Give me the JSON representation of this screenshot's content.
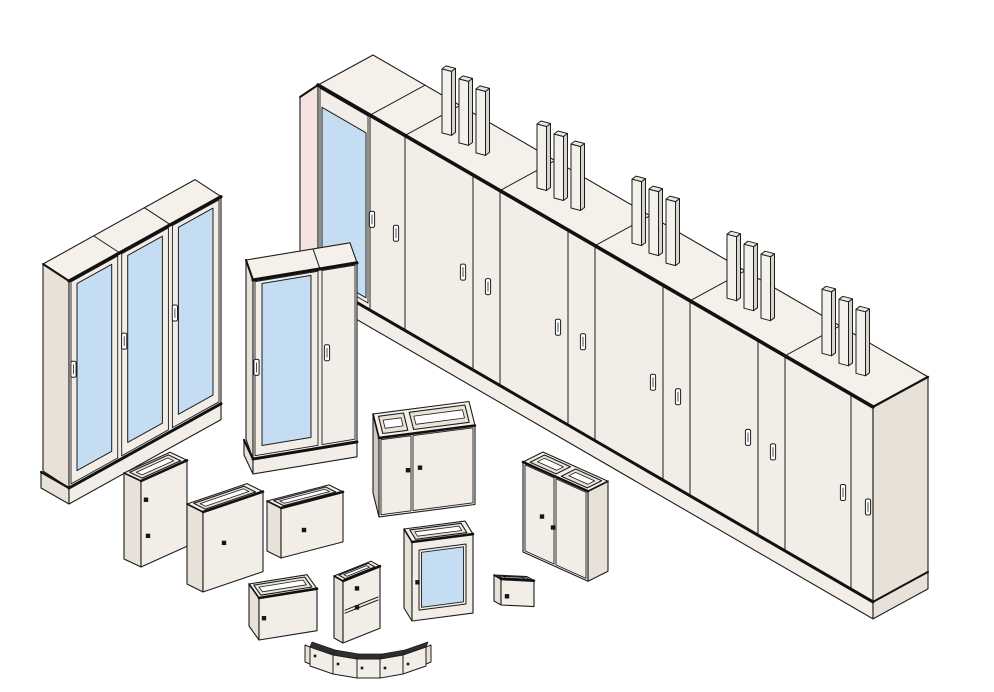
{
  "illustration": {
    "kind": "isometric line-art product range drawing of electrical enclosures",
    "palette": {
      "bg": "#ffffff",
      "line": "#1d1d1d",
      "thick": "#111111",
      "front": "#f2eee7",
      "top": "#f5f1ea",
      "side": "#e8e1d8",
      "sideDark": "#cfc9c0",
      "pink": "#f4e3e0",
      "glass": "#c4ddf2",
      "slotFace": "#e9e3da",
      "pillarFront": "#f3f1ec",
      "pillarSide": "#d8d4cc",
      "pillarTop": "#eae7e0",
      "latch": "#161616",
      "handle": "#ffffff",
      "band": "#2e2e2e"
    },
    "items": [
      {
        "id": "cabinet-row",
        "label": "floor-standing cabinet suite",
        "bays": 6,
        "glass_doors": 1,
        "door_handles": 12,
        "busbar_groups": 5,
        "pillars_per_group": 3
      },
      {
        "id": "triple-glass-door-cabinet",
        "label": "three-bay cabinet with glazed doors",
        "glass_doors": 3,
        "door_handles": 3
      },
      {
        "id": "double-bay-glass-door-cabinet",
        "label": "two-bay cabinet with glazed door",
        "glass_doors": 1,
        "solid_doors": 1,
        "door_handles": 2
      },
      {
        "id": "wall-box-tall",
        "label": "wall-mount enclosure tall",
        "latches": 2,
        "vent_slots": 1
      },
      {
        "id": "wall-box-medium",
        "label": "wall-mount enclosure medium",
        "latches": 1,
        "vent_slots": 1
      },
      {
        "id": "wall-box-small",
        "label": "wall-mount enclosure small",
        "latches": 1,
        "vent_slots": 1
      },
      {
        "id": "wall-box-wide",
        "label": "wall-mount enclosure wide",
        "latches": 1,
        "vent_slots": 1
      },
      {
        "id": "wall-box-two-tier",
        "label": "two-tier wall-mount enclosure",
        "latches": 2,
        "vent_slots": 1
      },
      {
        "id": "double-door-wall-box",
        "label": "double-door wall-mount enclosure",
        "latches": 2,
        "vent_slots": 2
      },
      {
        "id": "glazed-wall-box",
        "label": "wall-mount enclosure with window",
        "latches": 1,
        "vent_slots": 1
      },
      {
        "id": "double-door-wall-box-angled",
        "label": "double-door wall-mount enclosure angled",
        "latches": 2,
        "vent_slots": 2
      },
      {
        "id": "wall-box-mini",
        "label": "mini wall-mount enclosure",
        "latches": 1,
        "vent_slots": 1
      },
      {
        "id": "curved-cover-segments",
        "label": "curved segmented cover set",
        "segments": 5
      }
    ]
  }
}
